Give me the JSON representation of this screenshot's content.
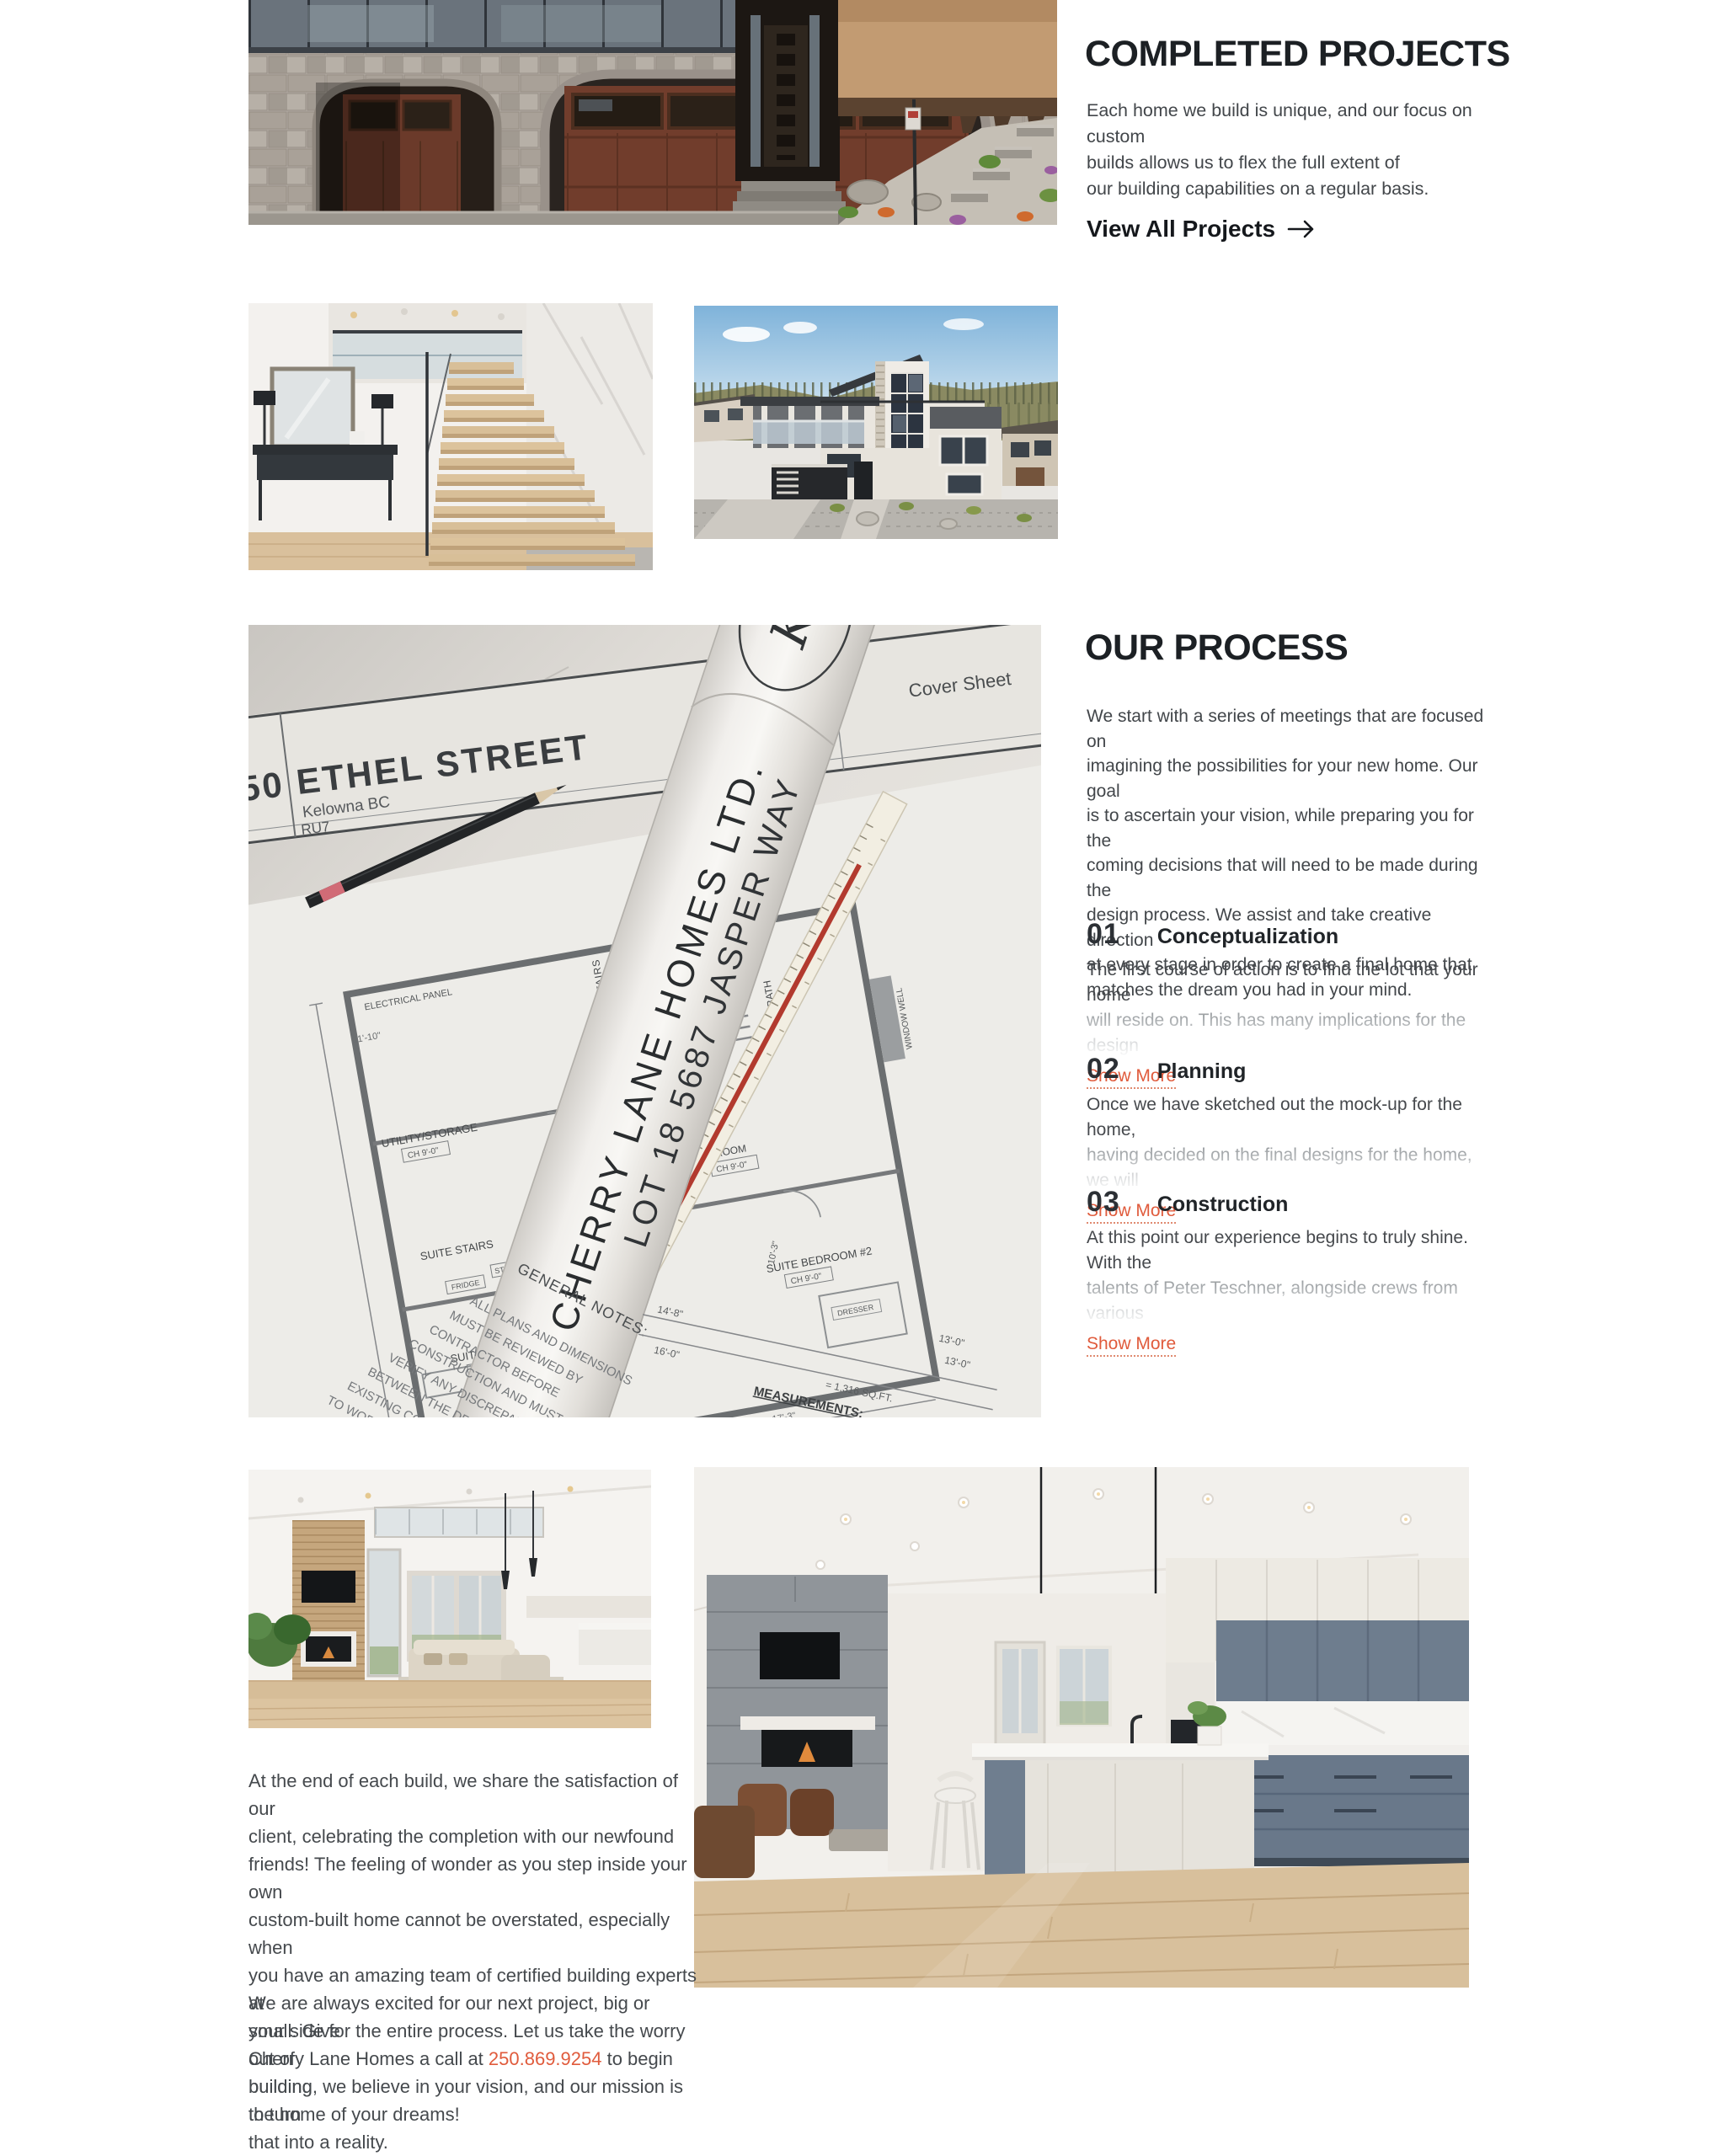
{
  "page": {
    "background": "#ffffff",
    "heading_color": "#1c2024",
    "body_color": "#45494d",
    "accent": "#e05b3c"
  },
  "completed_projects": {
    "title": "COMPLETED PROJECTS",
    "description_lines": [
      "Each home we build is unique, and our focus on custom",
      "builds allows us to flex the full extent of",
      "our building capabilities on a regular basis."
    ],
    "cta": {
      "label": "View All Projects",
      "icon": "arrow-right"
    }
  },
  "process": {
    "title": "OUR PROCESS",
    "description_lines": [
      "We start with a series of meetings that are focused on",
      "imagining the possibilities for your new home. Our goal",
      "is to ascertain your vision, while preparing you for the",
      "coming decisions that will need to be made during the",
      "design process. We assist and take creative direction",
      "at every stage in order to create a final home that",
      "matches the dream you had in your mind."
    ],
    "steps": [
      {
        "number": "01",
        "title": "Conceptualization",
        "teaser_line1": "The first course of action is to find the lot that your home",
        "teaser_line2": "will reside on. This has many implications for the design",
        "link": "Show More"
      },
      {
        "number": "02",
        "title": "Planning",
        "teaser_line1": "Once we have sketched out the mock-up for the home,",
        "teaser_line2": "having decided on the final designs for the home, we will",
        "link": "Show More"
      },
      {
        "number": "03",
        "title": "Construction",
        "teaser_line1": "At this point our experience begins to truly shine. With the",
        "teaser_line2": "talents of Peter Teschner, alongside crews from various",
        "link": "Show More"
      }
    ]
  },
  "closing": {
    "paragraph_lines": [
      "At the end of each build, we share the satisfaction of our",
      "client, celebrating the completion with our newfound",
      "friends! The feeling of wonder as you step inside your own",
      "custom-built home cannot be overstated, especially when",
      "you have an amazing team of certified building experts at",
      "your side for the entire process. Let us take the worry out of",
      "building, we believe in your vision, and our mission is to turn",
      "that into a reality."
    ],
    "cta_line1": "We are always excited for our next project, big or small. Give",
    "cta_line2_before": "Cherry Lane Homes a call at ",
    "phone": "250.869.9254",
    "cta_line2_after": " to begin building",
    "cta_line3": "the home of your dreams!"
  },
  "photos": {
    "hero_house": {
      "label": "stone custom home exterior",
      "house_number": "5630"
    },
    "staircase": {
      "label": "floating staircase foyer"
    },
    "modern_home": {
      "label": "modern custom home exterior"
    },
    "living_room": {
      "label": "great room with fireplace"
    },
    "kitchen": {
      "label": "kitchen with island"
    },
    "blueprint": {
      "label": "house blueprints with scale ruler and pencil",
      "street": "50 ETHEL STREET",
      "city": "Kelowna BC",
      "zoning": "RU7",
      "sheet": "Cover Sheet",
      "company": "CHERRY LANE HOMES LTD.",
      "lot": "LOT 18 5687 JASPER WAY",
      "logo": "KS",
      "logo_sub": "DESIGN",
      "ch_label": "CH 9'-0\"",
      "room_labels": [
        "SUITE KITCHEN",
        "SUITE STAIRS",
        "UTILITY/STORAGE",
        "ELECTRICAL PANEL",
        "STORAGE UNDER STAIRS",
        "SUITE BATH",
        "SUITE BEDROOM #2",
        "DRESSER",
        "FRIDGE",
        "STACKER",
        "ROOM",
        "WINDOW WELL"
      ],
      "dims": [
        "11'-10\"",
        "4'-6\"",
        "13'-3\"",
        "17'-3\"",
        "13'-0\"",
        "14'-8\"",
        "16'-0\"",
        "10'-3\""
      ],
      "notes_title": "GENERAL NOTES:",
      "notes_lines": [
        "ALL PLANS AND DIMENSIONS",
        "MUST BE REVIEWED BY",
        "CONTRACTOR BEFORE",
        "CONSTRUCTION AND MUST",
        "VERIFY ANY DISCREPANCIES",
        "BETWEEN THE DRAWINGS",
        "EXISTING CON",
        "TO WORK"
      ],
      "measurements_title": "MEASUREMENTS:",
      "measurements_item": "HOUSE AREA",
      "measurements_value": "= 1,316 SQ.FT."
    }
  }
}
